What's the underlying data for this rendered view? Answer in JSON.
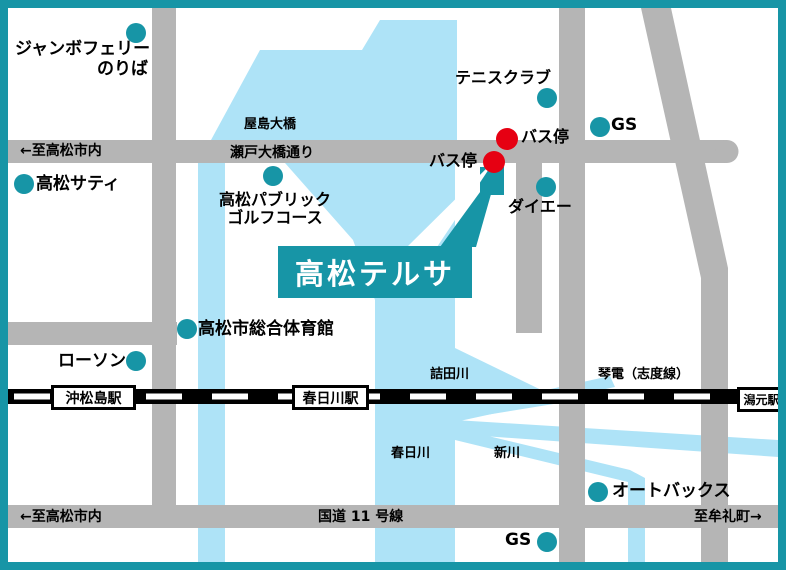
{
  "callout": {
    "label": "高松テルサ"
  },
  "places": {
    "jumbo_ferry_line1": "ジャンボフェリー",
    "jumbo_ferry_line2": "のりば",
    "takamatsu_saty": "高松サティ",
    "golf_line1": "高松パブリック",
    "golf_line2": "ゴルフコース",
    "tennis_club": "テニスクラブ",
    "bus_stop_upper": "バス停",
    "bus_stop_lower": "バス停",
    "gs_top": "GS",
    "gs_bottom": "GS",
    "daiei": "ダイエー",
    "gym": "高松市総合体育館",
    "lawson": "ローソン",
    "autobacs": "オートバックス"
  },
  "roads": {
    "to_takamatsu_top": "←至高松市内",
    "yashima_bridge": "屋島大橋",
    "seto_ohashi_street": "瀬戸大橋通り",
    "route11": "国道 11 号線",
    "to_takamatsu_bottom": "←至高松市内",
    "to_mure": "至牟礼町→"
  },
  "rivers": {
    "tsumetagawa": "詰田川",
    "kasugagawa": "春日川",
    "shinkawa": "新川"
  },
  "railway": {
    "line_label": "琴電（志度線）",
    "station_okimatsushima": "沖松島駅",
    "station_kasugagawa": "春日川駅",
    "station_katamoto": "潟元駅"
  },
  "colors": {
    "teal": "#1795a6",
    "water": "#aee3f7",
    "road_gray": "#b5b5b5",
    "bus_stop_red": "#e60012"
  }
}
